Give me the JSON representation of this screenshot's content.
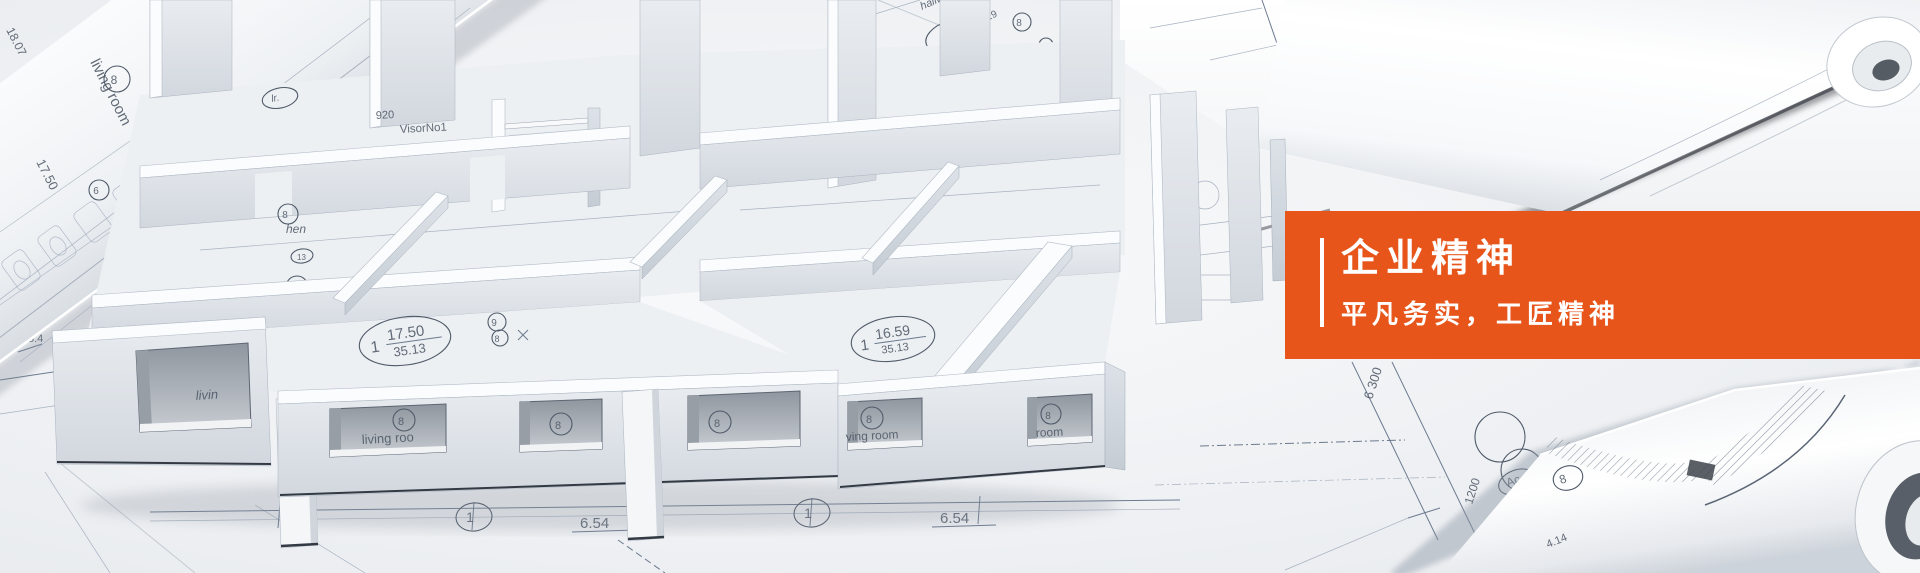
{
  "banner": {
    "title": "企业精神",
    "subtitle": "平凡务实，工匠精神",
    "accent_color": "#e7551b",
    "text_color": "#ffffff"
  },
  "labels": {
    "living_room": "living room",
    "living_roo": "living roo",
    "ving_room": "ving room",
    "room": "room",
    "livin": "livin",
    "liv": "liv",
    "hen": "hen",
    "hallway": "hallway",
    "visor": "VisorNo1",
    "n920": "920",
    "lr": "lr.",
    "one": "1",
    "c6": "6",
    "c7": "7",
    "c8": "8",
    "c9": "9",
    "c13": "13",
    "area_17_50": "17.50",
    "area_35_13": "35.13",
    "area_16_59": "16.59",
    "area_12_50": "12.50",
    "d_6_54": "6.54",
    "d_5550": "5550",
    "d_6300": "6 300",
    "d_1200": "1200",
    "d_1_25": "1.25",
    "d_18_07": "18.07",
    "d_1_29": "1.29",
    "d_8_4": "8.4",
    "d_0_60": "0.60",
    "d_4_14": "4.14",
    "ac": "Ac"
  }
}
